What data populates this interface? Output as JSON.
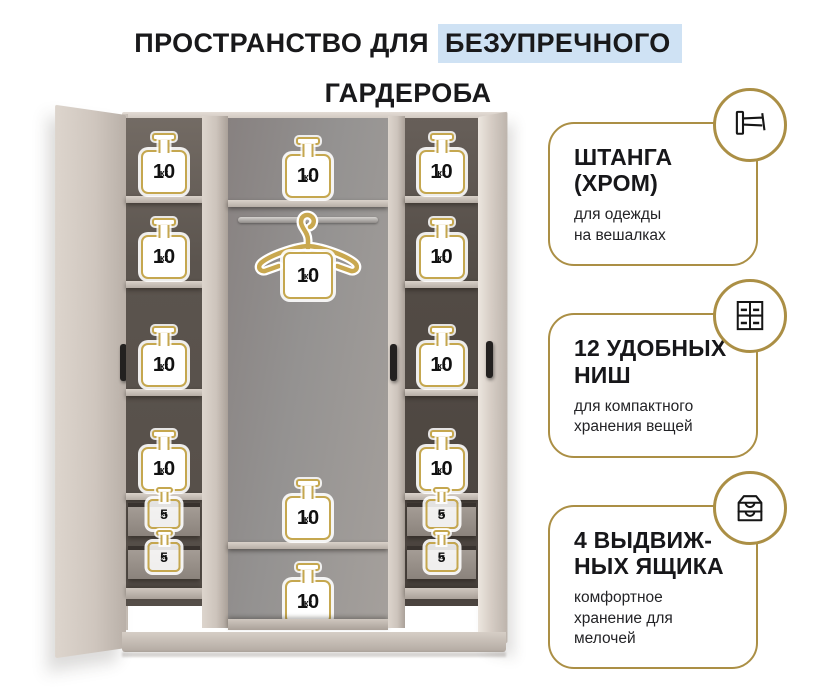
{
  "title": {
    "line1_prefix": "ПРОСТРАНСТВО ДЛЯ",
    "line1_highlight": "БЕЗУПРЕЧНОГО",
    "line2": "ГАРДЕРОБА"
  },
  "colors": {
    "accent_gold": "#ab8f45",
    "weight_gold": "#c5a74f",
    "highlight_blue": "#cfe2f4"
  },
  "wardrobe": {
    "weight_unit": "кг",
    "left_column": {
      "shelf_weights": [
        "10",
        "10",
        "10",
        "10"
      ],
      "drawer_weights": [
        "5",
        "5"
      ]
    },
    "middle_column": {
      "top_weight": "10",
      "hanger_weight": "10",
      "shelf_weight": "10",
      "bottom_weight": "10"
    },
    "right_column": {
      "shelf_weights": [
        "10",
        "10",
        "10",
        "10"
      ],
      "drawer_weights": [
        "5",
        "5"
      ]
    }
  },
  "callouts": [
    {
      "icon": "clothes-rail-icon",
      "title": "ШТАНГА\n(ХРОМ)",
      "subtitle": "для одежды\nна вешалках"
    },
    {
      "icon": "shelves-icon",
      "title": "12 УДОБНЫХ\nНИШ",
      "subtitle": "для компактного\nхранения вещей"
    },
    {
      "icon": "drawers-icon",
      "title": "4 ВЫДВИЖ-\nНЫХ ЯЩИКА",
      "subtitle": "комфортное\nхранение для\nмелочей"
    }
  ]
}
